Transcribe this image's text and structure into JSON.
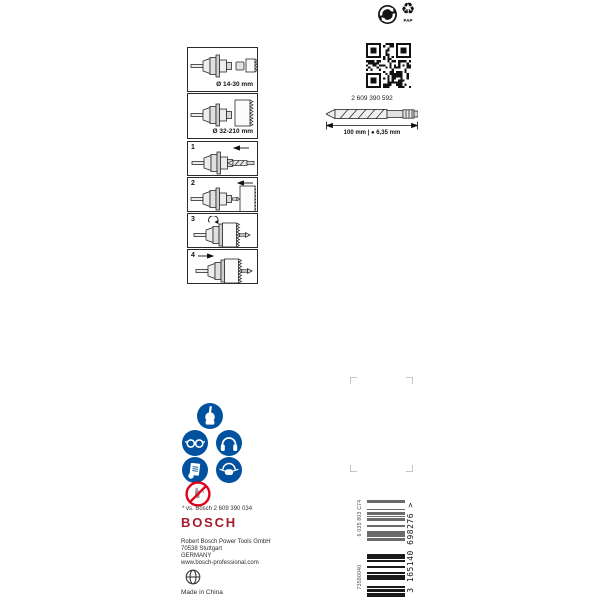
{
  "recycling": {
    "pap_number": "21",
    "pap_material": "PAP"
  },
  "diameter_boxes": [
    {
      "label": "Ø 14-30 mm"
    },
    {
      "label": "Ø 32-210 mm"
    }
  ],
  "steps": [
    {
      "num": "1"
    },
    {
      "num": "2"
    },
    {
      "num": "3"
    },
    {
      "num": "4"
    }
  ],
  "product": {
    "order_number": "2 609 390 592",
    "dimensions": "100 mm | ● 6,35 mm"
  },
  "footnote": "* vs. Bosch 2 609 390 034",
  "brand": {
    "logo_text": "BOSCH",
    "address": [
      "Robert Bosch Power Tools GmbH",
      "70538 Stuttgart",
      "GERMANY",
      "www.bosch-professional.com"
    ],
    "made_in": "Made in China"
  },
  "barcode": {
    "ean_text": "3 165140 698276 >",
    "article_code": "6 035 803 C74",
    "batch_code": "73590040"
  },
  "icons": {
    "green_dot": "green-dot recycling mark",
    "recycling_triangle": "paper recycling triangle 21 PAP",
    "qr_code": "data-matrix / QR code",
    "safety": [
      "wear protective gloves",
      "wear safety glasses",
      "wear ear protection",
      "read instruction manual",
      "wear dust mask",
      "prohibition"
    ],
    "globe": "globe mark"
  },
  "colors": {
    "bosch_red": "#a61c2c",
    "safety_blue": "#00519e",
    "prohibition_red": "#e2001a"
  }
}
